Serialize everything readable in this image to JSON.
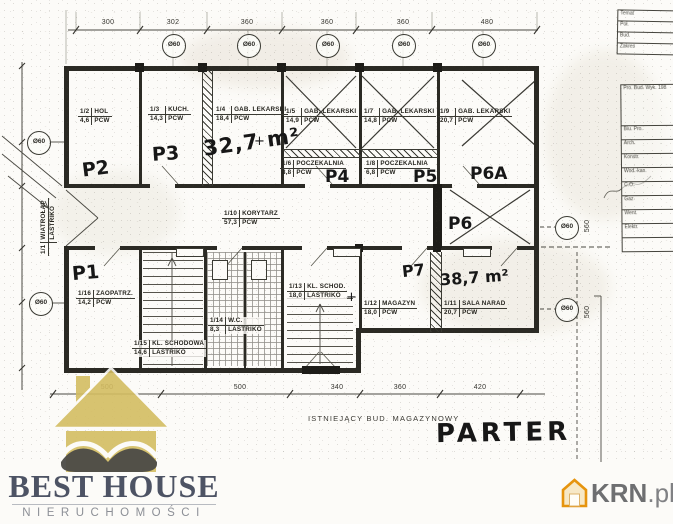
{
  "plan": {
    "floor_label": "PARTER",
    "bottom_note": "ISTNIEJĄCY BUD. MAGAZYNOWY",
    "column_marker": "Ø60",
    "plus_mark": "+",
    "units": {
      "p1": "P1",
      "p2": "P2",
      "p3": "P3",
      "p4": "P4",
      "p5": "P5",
      "p6": "P6",
      "p6a": "P6A",
      "p7": "P7"
    },
    "areas": {
      "a1": "32,7 m²",
      "a2": "38,7 m²"
    },
    "rooms": [
      {
        "no": "1/1",
        "name": "WIATROŁAP",
        "area": "",
        "floor": "LASTRIKO"
      },
      {
        "no": "1/2",
        "name": "HOL",
        "area": "4,6",
        "floor": "PCW"
      },
      {
        "no": "1/3",
        "name": "KUCH.",
        "area": "14,3",
        "floor": "PCW"
      },
      {
        "no": "1/4",
        "name": "GAB. LEKARSKI",
        "area": "18,4",
        "floor": "PCW"
      },
      {
        "no": "1/5",
        "name": "GAB. LEKARSKI",
        "area": "14,9",
        "floor": "PCW"
      },
      {
        "no": "1/6",
        "name": "POCZEKALNIA",
        "area": "8,8",
        "floor": "PCW"
      },
      {
        "no": "1/7",
        "name": "GAB. LEKARSKI",
        "area": "14,8",
        "floor": "PCW"
      },
      {
        "no": "1/8",
        "name": "POCZEKALNIA",
        "area": "6,8",
        "floor": "PCW"
      },
      {
        "no": "1/9",
        "name": "GAB. LEKARSKI",
        "area": "20,7",
        "floor": "PCW"
      },
      {
        "no": "1/10",
        "name": "KORYTARZ",
        "area": "57,3",
        "floor": "PCW"
      },
      {
        "no": "1/11",
        "name": "SALA NARAD",
        "area": "20,7",
        "floor": "PCW"
      },
      {
        "no": "1/12",
        "name": "MAGAZYN",
        "area": "18,0",
        "floor": "PCW"
      },
      {
        "no": "1/13",
        "name": "KL. SCHOD.",
        "area": "18,0",
        "floor": "LASTRIKO"
      },
      {
        "no": "1/14",
        "name": "W.C.",
        "area": "8,3",
        "floor": "LASTRIKO"
      },
      {
        "no": "1/15",
        "name": "KL. SCHODOWA",
        "area": "14,6",
        "floor": "LASTRIKO"
      },
      {
        "no": "1/16",
        "name": "ZAOPATRZ.",
        "area": "14,2",
        "floor": "PCW"
      }
    ],
    "dimensions": {
      "top": [
        "300",
        "302",
        "360",
        "360",
        "360",
        "480"
      ],
      "bottom": [
        "500",
        "500",
        "340",
        "360",
        "420"
      ],
      "right": [
        "560",
        "560"
      ]
    }
  },
  "title_block": {
    "top_rows": [
      "Temat",
      "Poł.",
      "Bud.",
      "Zakres"
    ],
    "info_lines": [
      "Pro. Bud. Wyk. 198",
      "Biu. Pro."
    ],
    "trade_rows": [
      "Arch.",
      "Konstr.",
      "Wod.-kan.",
      "C.O.",
      "Gaz",
      "Went.",
      "Elektr."
    ]
  },
  "branding": {
    "best_house": {
      "title": "BEST HOUSE",
      "subtitle": "NIERUCHOMOŚCI",
      "house_color": "#d4bd62",
      "wave_color": "#4b4a46",
      "text_color": "#4d5364"
    },
    "krn": {
      "text_main": "KRN",
      "text_suffix": ".pl",
      "icon_color": "#e6940e",
      "text_color": "#6e6f71"
    }
  }
}
